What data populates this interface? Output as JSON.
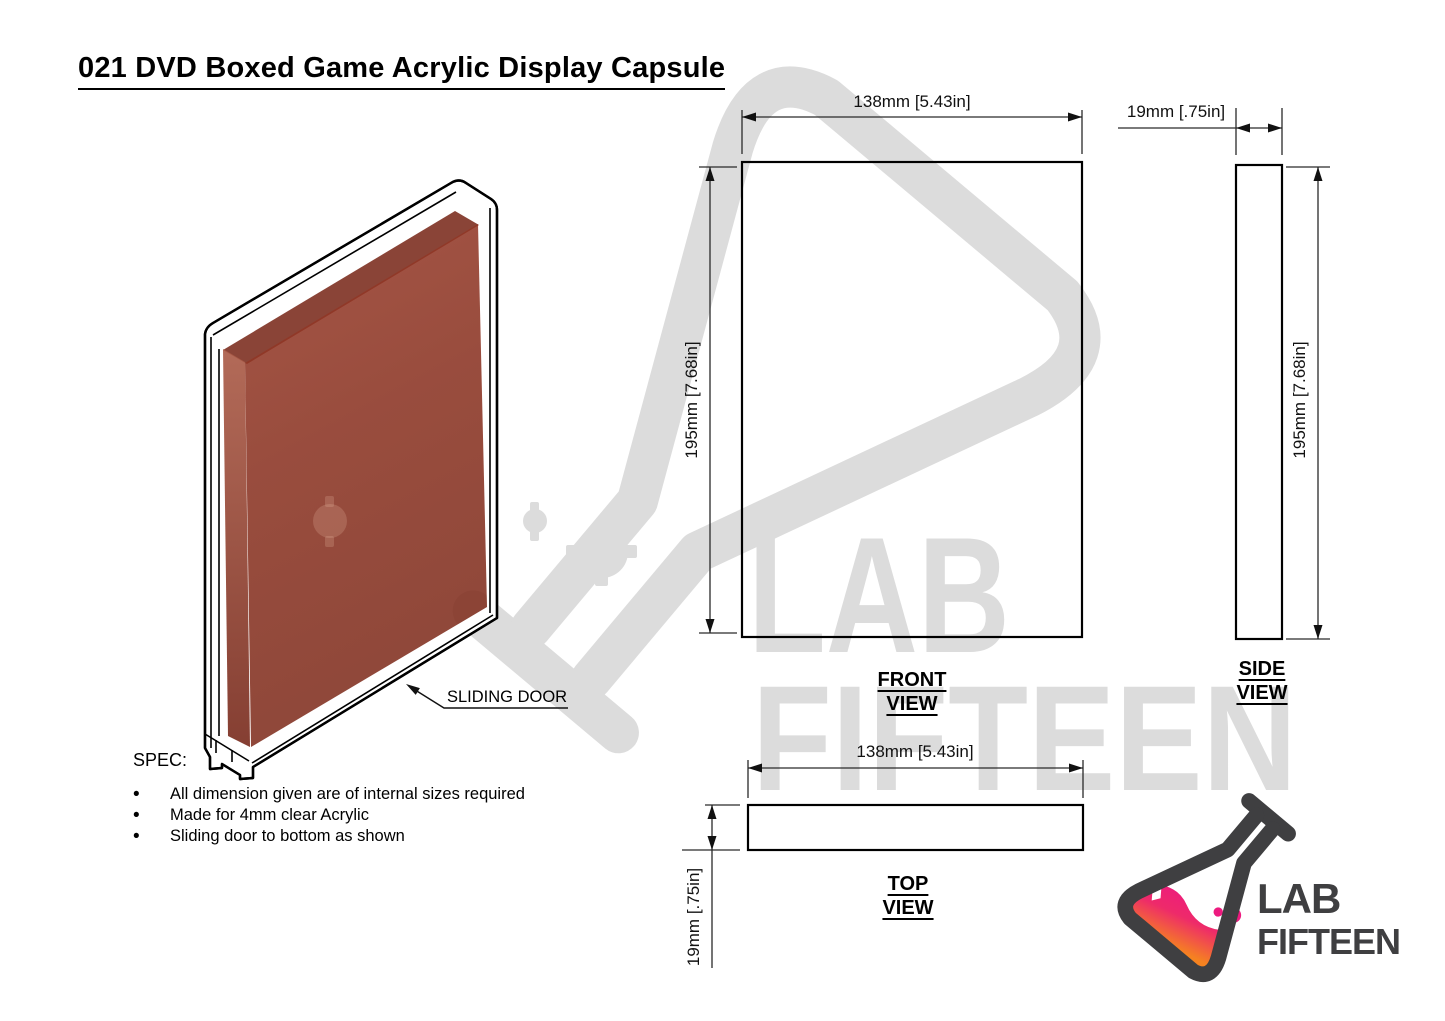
{
  "title": "021 DVD Boxed Game Acrylic Display Capsule",
  "spec": {
    "heading": "SPEC:",
    "bullets": [
      "All dimension given are of internal sizes required",
      "Made for 4mm clear Acrylic",
      "Sliding door to bottom as shown"
    ]
  },
  "annotations": {
    "sliding_door": "SLIDING DOOR"
  },
  "views": {
    "front": {
      "label_line1": "FRONT",
      "label_line2": "VIEW",
      "width_dim": "138mm [5.43in]",
      "height_dim": "195mm [7.68in]"
    },
    "side": {
      "label_line1": "SIDE",
      "label_line2": "VIEW",
      "width_dim": "19mm [.75in]",
      "height_dim": "195mm [7.68in]"
    },
    "top": {
      "label_line1": "TOP",
      "label_line2": "VIEW",
      "width_dim": "138mm [5.43in]",
      "height_dim": "19mm [.75in]"
    }
  },
  "watermark": {
    "line1": "LAB",
    "line2": "FIFTEEN"
  },
  "logo": {
    "line1": "LAB",
    "line2": "FIFTEEN"
  },
  "colors": {
    "line": "#000000",
    "watermark_gray": "#dcdcdc",
    "dvd_box_red": "#8f3119",
    "logo_outline": "#3f3f41",
    "logo_pink": "#ed1a7f",
    "logo_orange": "#f58220"
  }
}
